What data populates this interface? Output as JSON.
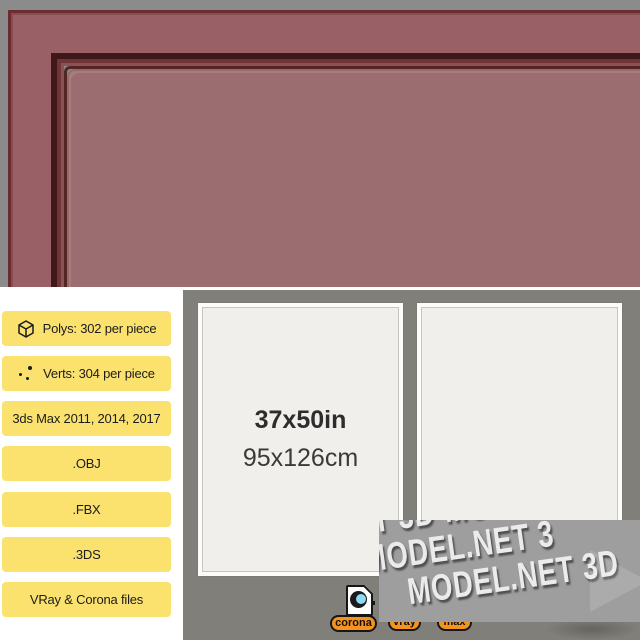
{
  "specs": {
    "badges": [
      {
        "icon": "cube-icon",
        "label": "Polys: 302 per piece"
      },
      {
        "icon": "verts-icon",
        "label": "Verts: 304 per piece"
      },
      {
        "label": "3ds Max 2011, 2014, 2017"
      },
      {
        "label": ".OBJ"
      },
      {
        "label": ".FBX"
      },
      {
        "label": ".3DS"
      },
      {
        "label": "VRay & Corona files"
      }
    ]
  },
  "preview": {
    "size_label_in": "37x50in",
    "size_label_cm": "95x126cm"
  },
  "watermark": {
    "text": "3D-MODEL.NET",
    "rows": [
      "ET 3D-MODEL.N",
      "3D-MODEL.NET 3",
      "MODEL.NET 3D"
    ]
  },
  "renderers": {
    "corona": "corona",
    "vray": "vray",
    "max": "max"
  },
  "colors": {
    "badge_yellow": "#FBE26F",
    "pill_orange": "#F6921E",
    "frame_rose": "#996165",
    "frame_rose_inner": "#9C6D70",
    "render_bg_gray": "#8B8B8B",
    "panel_gray": "#807F79",
    "watermark_gray": "#9E9E9E",
    "corona_blue": "#8FD9F5"
  }
}
